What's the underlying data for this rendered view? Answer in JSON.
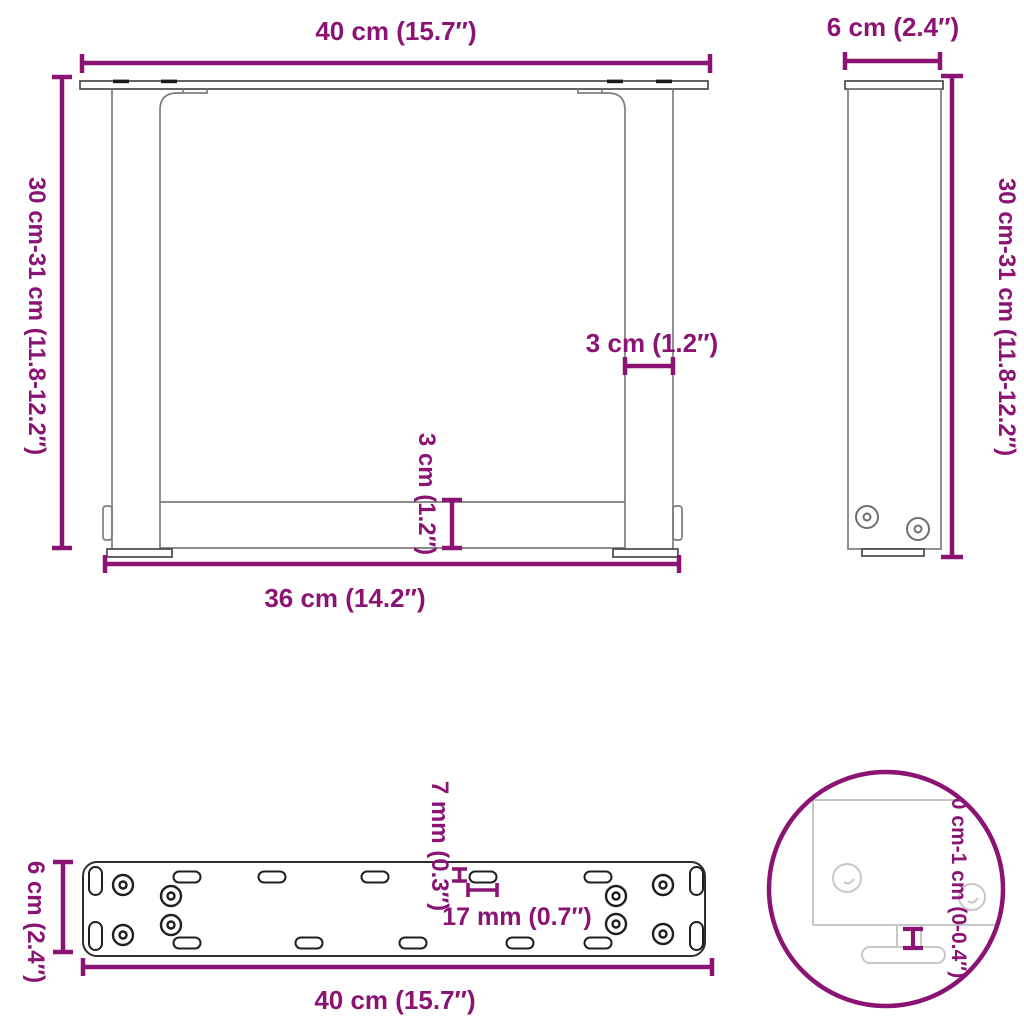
{
  "colors": {
    "dimension": "#8B1374",
    "steel_outline": "#7d7d7d",
    "plate_outline": "#2e2e2e",
    "detail_ghost": "#c7c7c7"
  },
  "views": {
    "front": {
      "dims": {
        "width_top": "40 cm (15.7″)",
        "height_left": "30 cm-31 cm (11.8-12.2″)",
        "leg_width": "3 cm (1.2″)",
        "bar_height": "3 cm (1.2″)",
        "width_bottom": "36 cm (14.2″)"
      }
    },
    "side": {
      "dims": {
        "depth_top": "6 cm (2.4″)",
        "height_right": "30 cm-31 cm (11.8-12.2″)"
      }
    },
    "plate": {
      "dims": {
        "depth_left": "6 cm (2.4″)",
        "slot_height": "7 mm (0.3″)",
        "slot_width": "17 mm (0.7″)",
        "width_bottom": "40 cm (15.7″)"
      }
    },
    "detail": {
      "dims": {
        "adjustable_height": "0 cm-1 cm (0-0.4″)"
      }
    }
  }
}
